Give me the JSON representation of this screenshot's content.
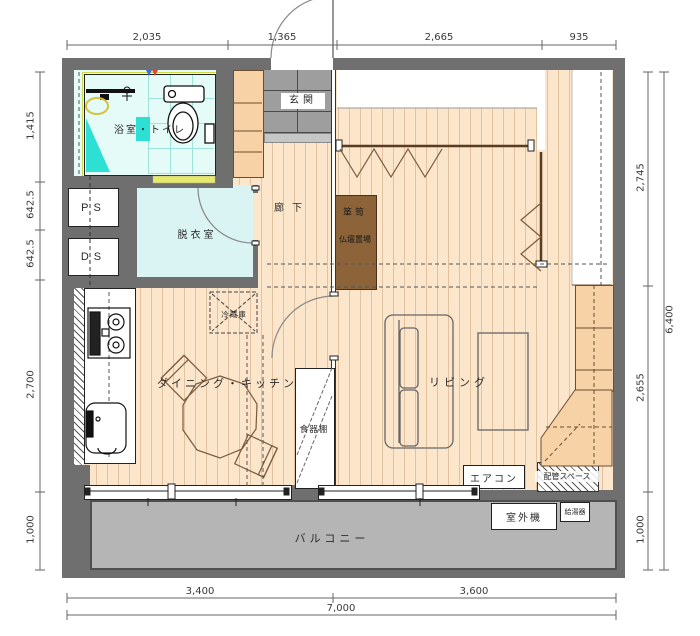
{
  "rooms": {
    "bathroom": "浴室・トイレ",
    "entrance": "玄関",
    "corridor": "廊下",
    "dressing_room": "脱衣室",
    "dining_kitchen": "ダイニング・キッチン",
    "living": "リビング",
    "balcony": "バルコニー"
  },
  "labels": {
    "ps": "PS",
    "ds": "DS",
    "tansu": "箪笥",
    "butsudan_space": "仏壇置場",
    "refrigerator": "冷蔵庫",
    "cupboard": "食器棚",
    "air_conditioner": "エアコン",
    "piping_space": "配管スペース",
    "outdoor_unit": "室外機",
    "water_heater": "給湯器"
  },
  "dimensions": {
    "top": [
      "2,035",
      "1,365",
      "2,665",
      "935"
    ],
    "left": [
      "1,415",
      "642.5",
      "642.5",
      "2,700",
      "1,000"
    ],
    "right": [
      "2,745",
      "2,655",
      "1,000"
    ],
    "right_total": "6,400",
    "bottom": [
      "3,400",
      "3,600"
    ],
    "bottom_total": "7,000"
  },
  "colors": {
    "wall": "#6f6f6f",
    "wood_floor": "#fbe5cb",
    "bath_floor": "#e4fbf7",
    "dressing_floor": "#d9f4f2",
    "balcony_floor": "#b5b5b5",
    "cabinet": "#f6d2a6",
    "tansu": "#8d6339",
    "accent_cyan": "#2ee0d4",
    "door_yellow": "#e6e96a"
  }
}
